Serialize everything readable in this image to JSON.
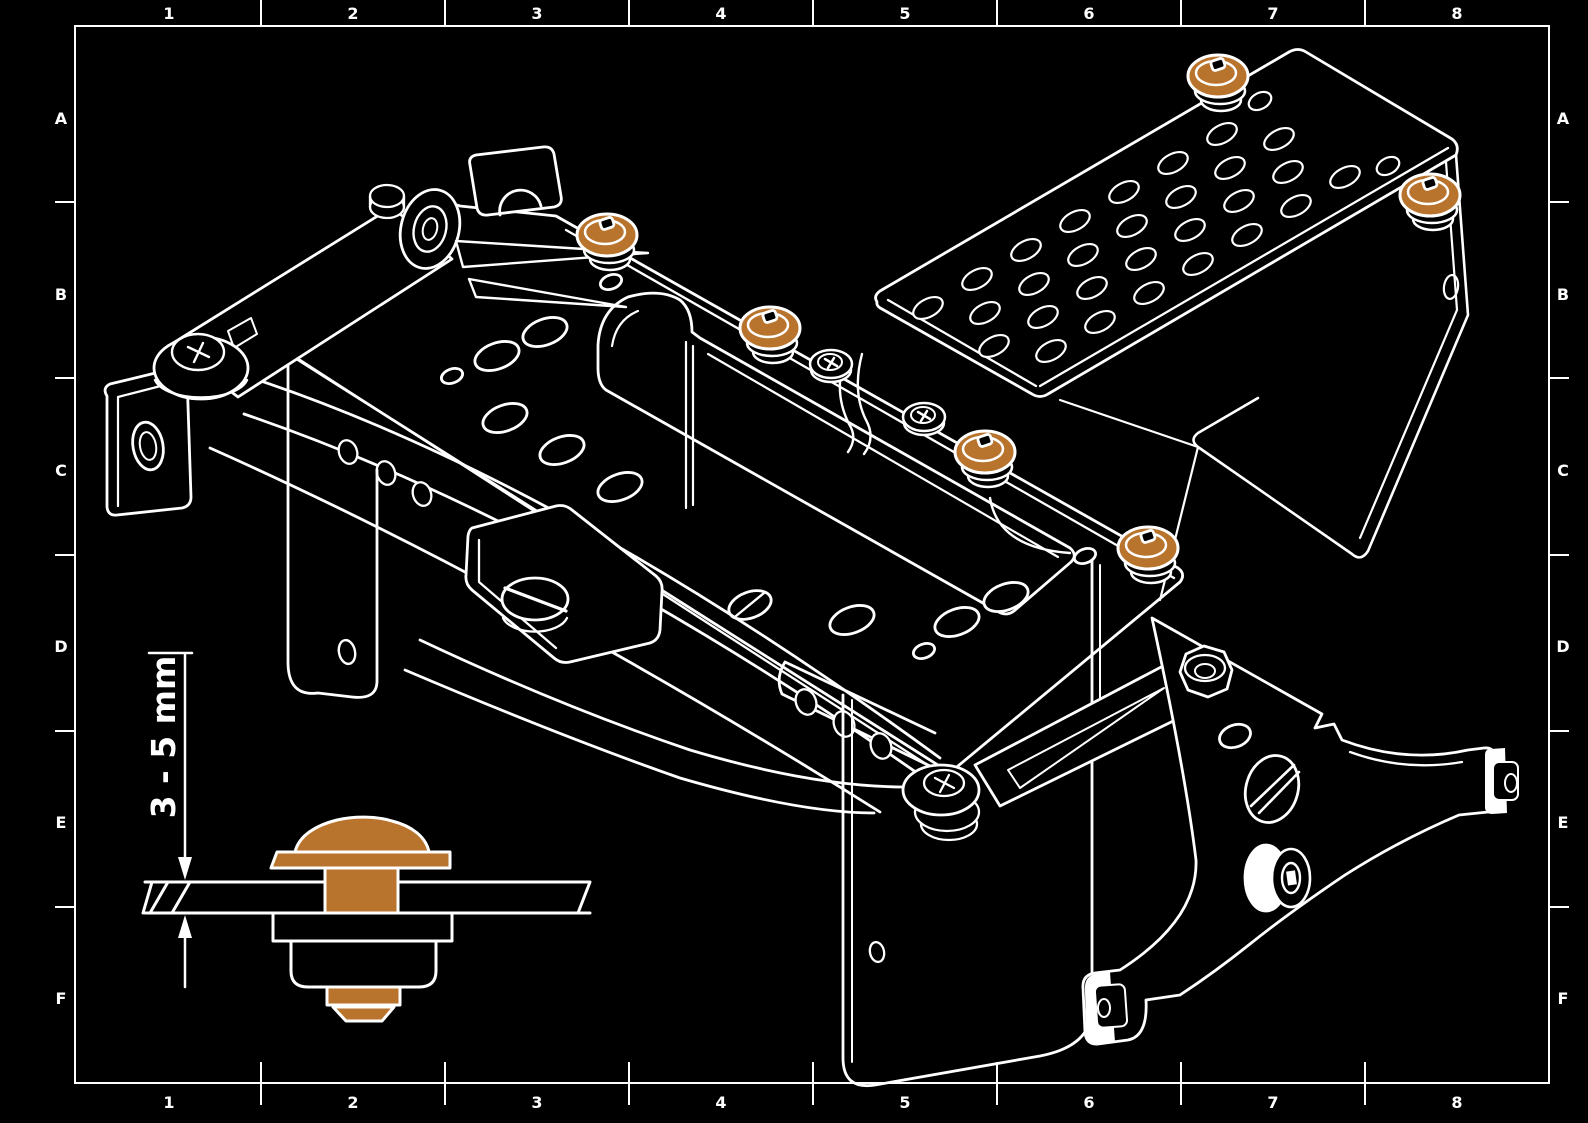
{
  "scene": {
    "background": "#000000",
    "line_color": "#ffffff",
    "highlight_color": "#b8732c",
    "kind": "isometric-technical-line-drawing"
  },
  "frame": {
    "columns": [
      "1",
      "2",
      "3",
      "4",
      "5",
      "6",
      "7",
      "8"
    ],
    "rows": [
      "A",
      "B",
      "C",
      "D",
      "E",
      "F"
    ]
  },
  "assembly": {
    "highlighted_fastener_count": 6,
    "fastener_icon": "snap-grommet-icon"
  },
  "detail_view": {
    "dimension_label": "3 - 5 mm"
  }
}
